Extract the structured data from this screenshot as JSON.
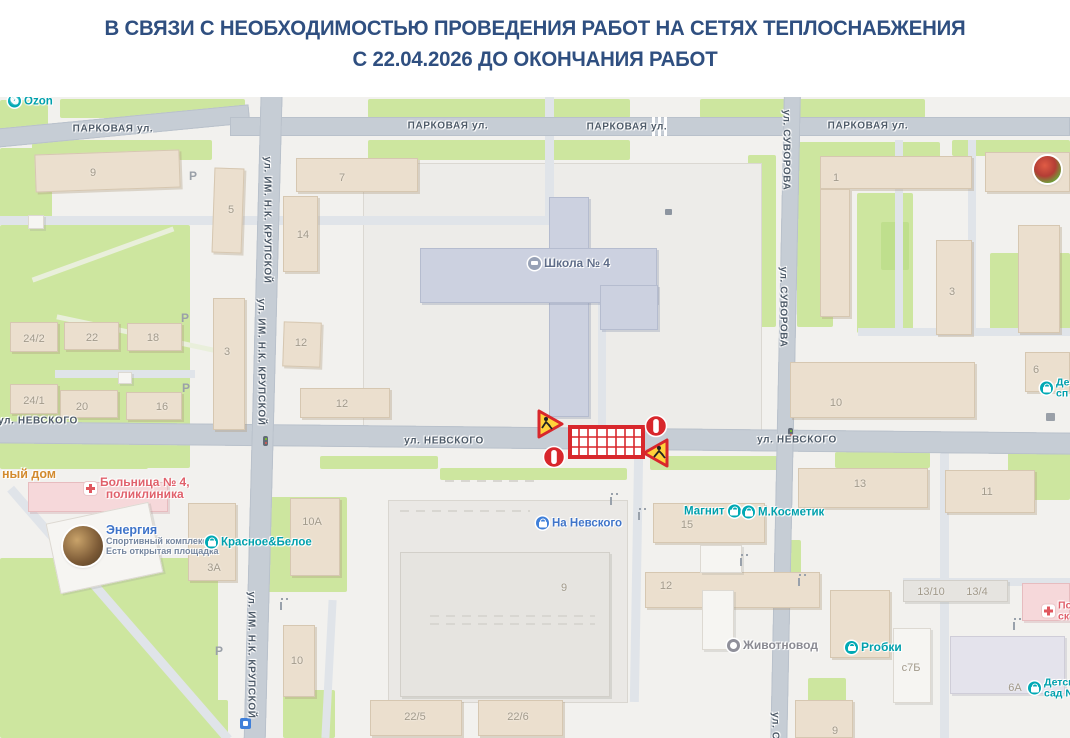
{
  "header": {
    "line1": "В СВЯЗИ С НЕОБХОДИМОСТЬЮ ПРОВЕДЕНИЯ РАБОТ НА СЕТЯХ ТЕПЛОСНАБЖЕНИЯ",
    "line2": "С 22.04.2026 ДО ОКОНЧАНИЯ РАБОТ"
  },
  "map": {
    "street_labels": [
      {
        "text": "ПАРКОВАЯ ул."
      },
      {
        "text": "ПАРКОВАЯ ул."
      },
      {
        "text": "ПАРКОВАЯ ул."
      },
      {
        "text": "ПАРКОВАЯ ул."
      },
      {
        "text": "ул. НЕВСКОГО"
      },
      {
        "text": "ул. НЕВСКОГО"
      },
      {
        "text": "ул. НЕВСКОГО"
      },
      {
        "text": "ул. ИМ. Н.К. КРУПСКОЙ"
      },
      {
        "text": "ул. ИМ. Н.К. КРУПСКОЙ"
      },
      {
        "text": "ул. ИМ. Н.К. КРУПСКОЙ"
      },
      {
        "text": "ул. СУВОРОВА"
      },
      {
        "text": "ул. СУВОРОВА"
      },
      {
        "text": "ул. Су"
      }
    ],
    "parking": {
      "text": "Р"
    },
    "building_numbers": [
      {
        "text": "9"
      },
      {
        "text": "7"
      },
      {
        "text": "5"
      },
      {
        "text": "14"
      },
      {
        "text": "1"
      },
      {
        "text": "3"
      },
      {
        "text": "6"
      },
      {
        "text": "24/2"
      },
      {
        "text": "22"
      },
      {
        "text": "18"
      },
      {
        "text": "24/1"
      },
      {
        "text": "20"
      },
      {
        "text": "16"
      },
      {
        "text": "3"
      },
      {
        "text": "12"
      },
      {
        "text": "12"
      },
      {
        "text": "10"
      },
      {
        "text": "13"
      },
      {
        "text": "11"
      },
      {
        "text": "15"
      },
      {
        "text": "10А"
      },
      {
        "text": "3А"
      },
      {
        "text": "9"
      },
      {
        "text": "12"
      },
      {
        "text": "13/10"
      },
      {
        "text": "13/4"
      },
      {
        "text": "с7Б"
      },
      {
        "text": "6А"
      },
      {
        "text": "10"
      },
      {
        "text": "22/5"
      },
      {
        "text": "22/6"
      },
      {
        "text": "9"
      }
    ],
    "pois": [
      {
        "text": "Ozon"
      },
      {
        "text": "Школа № 4"
      },
      {
        "line1": "Больница № 4,",
        "line2": "поликлиника"
      },
      {
        "title": "Энергия",
        "sub1": "Спортивный комплекс",
        "sub2": "Есть открытая площадка"
      },
      {
        "text": "Красное&Белое"
      },
      {
        "text": "На Невского"
      },
      {
        "text": "Магнит"
      },
      {
        "text": "М.Косметик"
      },
      {
        "text": "Животновод"
      },
      {
        "text": "Рrобки"
      },
      {
        "line1": "Детск",
        "line2": "сад N"
      },
      {
        "line1": "По",
        "line2": "ск"
      },
      {
        "line1": "Де",
        "line2": "сп"
      },
      {
        "text": "ный дом"
      }
    ],
    "closure": {
      "description": "road works barrier with no-entry signs and roadworks warning triangles",
      "start_date_shown_in_header": "22.04.2026"
    },
    "colors": {
      "header_blue": "#2f4f80",
      "poi_teal": "#00a0ac",
      "poi_blue": "#3f74c9",
      "poi_red": "#e0606b",
      "closure_red": "#d8272c",
      "warning_yellow": "#ffd23b",
      "road_gray": "#c6cdd5",
      "green": "#cde69f"
    }
  }
}
